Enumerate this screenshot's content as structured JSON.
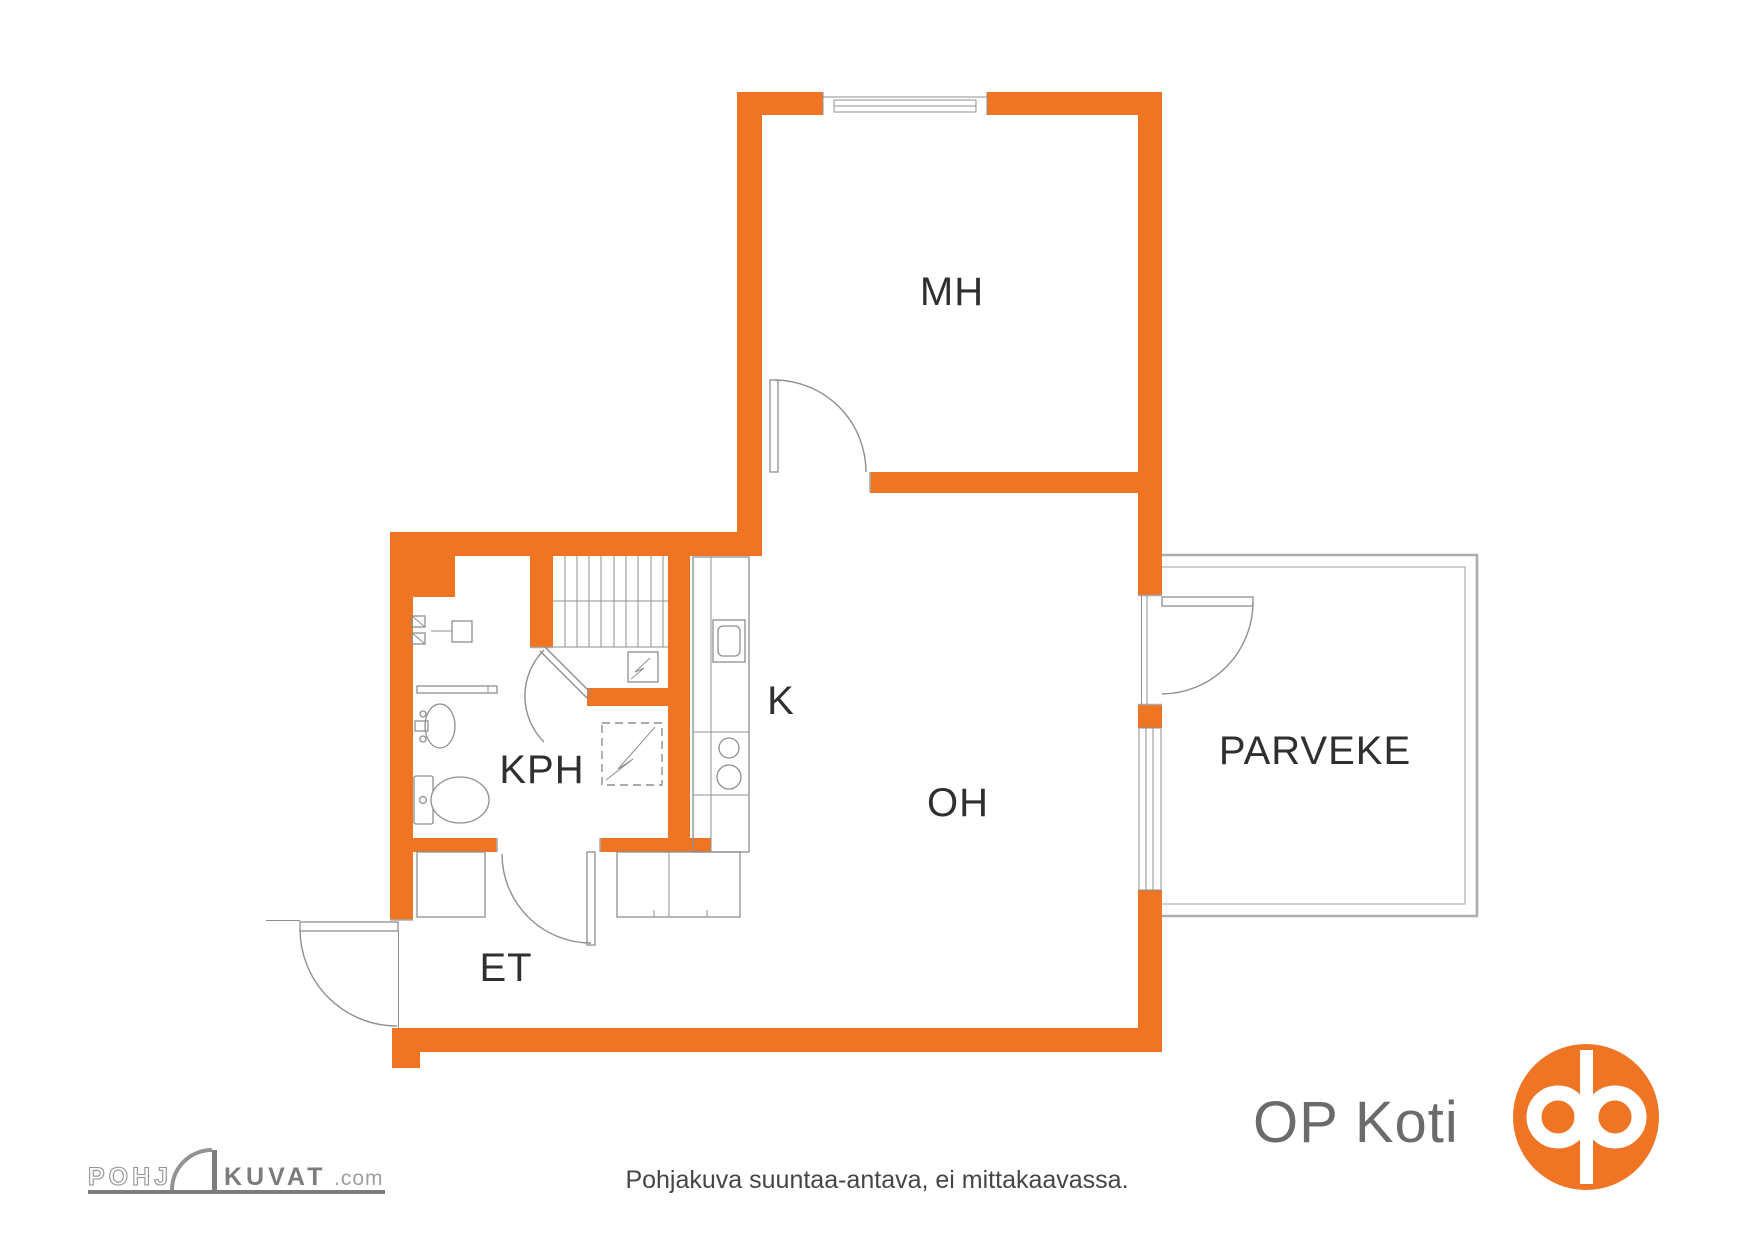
{
  "document": {
    "kind": "apartment floor plan",
    "language": "Finnish"
  },
  "colors": {
    "wall_orange": "#ef7423",
    "brand_orange": "#ef7423",
    "line_gray": "#8c8f91",
    "label_dark": "#2d2f31",
    "logo_gray": "#6b6b6b",
    "footer_gray": "#454545"
  },
  "rooms": {
    "mh": "MH",
    "oh": "OH",
    "k": "K",
    "kph": "KPH",
    "et": "ET",
    "parveke": "PARVEKE"
  },
  "fixtures": [
    "stairs",
    "kitchen-counter",
    "kitchen-sink",
    "stove-burners",
    "washing-machine",
    "water-heater",
    "electrical-panel",
    "washbasin",
    "toilet",
    "shelf",
    "closets",
    "window",
    "balcony-door",
    "entry-door",
    "room-doors"
  ],
  "footer": {
    "disclaimer": "Pohjakuva suuntaa-antava, ei mittakaavassa."
  },
  "branding": {
    "op_koti": {
      "text": "OP Koti"
    },
    "pohjakuvat": {
      "prefix": "POHJ",
      "main": "KUVAT",
      "suffix": ".com"
    }
  }
}
